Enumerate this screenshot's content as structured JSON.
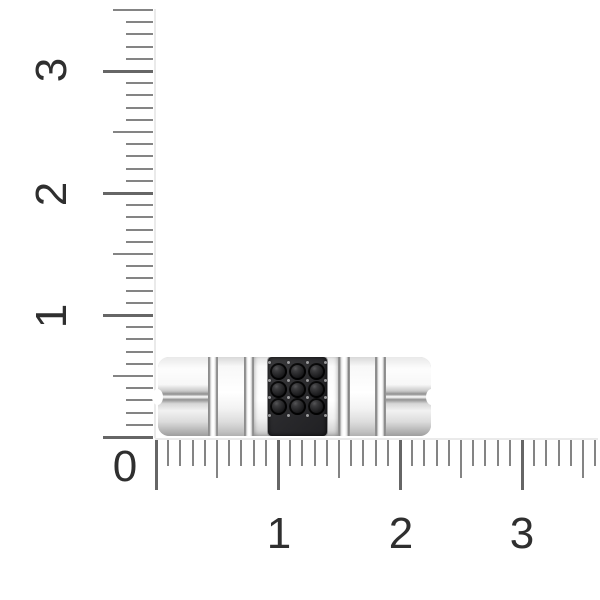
{
  "scene": {
    "background_color": "#ffffff",
    "object": "silver ring band with square pave of black stones",
    "ring": {
      "stone_rows": 3,
      "stone_cols": 3,
      "stone_color": "#1b1b1d",
      "setting_color": "#2a2a2c",
      "prong_color": "#9c9c9e",
      "metal_highlight": "#ffffff",
      "metal_shadow": "#9e9e9e"
    }
  },
  "rulers": {
    "tick_color": "#848484",
    "major_tick_color": "#666666",
    "label_color": "#2f2f2f",
    "edge_color": "#eaeaea",
    "px_per_unit": 122,
    "minor_per_unit": 10,
    "vertical": {
      "origin_x": 153,
      "origin_y": 437,
      "length_units": 3.5,
      "tick_lengths": {
        "minor": 27,
        "medium": 40,
        "major": 50
      },
      "labels": [
        {
          "text": "3",
          "x": 52,
          "y": 70
        },
        {
          "text": "2",
          "x": 52,
          "y": 194
        },
        {
          "text": "1",
          "x": 52,
          "y": 316
        }
      ]
    },
    "horizontal": {
      "origin_x": 156,
      "origin_y": 440,
      "length_units": 3.6,
      "tick_lengths": {
        "minor": 26,
        "medium": 38,
        "major": 50
      },
      "labels": [
        {
          "text": "1",
          "x": 279,
          "y": 534
        },
        {
          "text": "2",
          "x": 401,
          "y": 534
        },
        {
          "text": "3",
          "x": 522,
          "y": 534
        }
      ]
    },
    "zero_label": {
      "text": "0",
      "x": 125,
      "y": 467
    }
  }
}
